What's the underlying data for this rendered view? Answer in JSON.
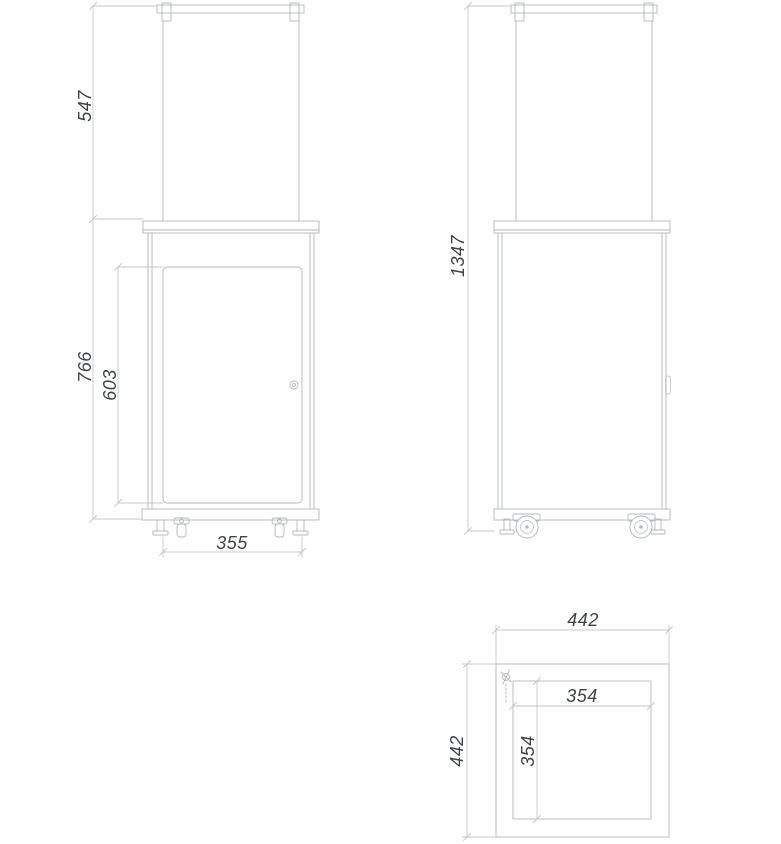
{
  "colors": {
    "background": "#ffffff",
    "line": "#b3b7ba",
    "line_light": "#c3c7ca",
    "text": "#3f4245"
  },
  "drawing": {
    "type": "technical-dimension-drawing",
    "views": {
      "front": {
        "name": "front-view"
      },
      "side": {
        "name": "side-view"
      },
      "top": {
        "name": "top-view"
      }
    }
  },
  "dimensions": {
    "front": {
      "glass_height": "547",
      "cabinet_height": "766",
      "door_height": "603",
      "base_width": "355"
    },
    "side": {
      "overall_height": "1347"
    },
    "top": {
      "outer_width": "442",
      "outer_depth": "442",
      "inner_width": "354",
      "inner_depth": "354"
    }
  }
}
